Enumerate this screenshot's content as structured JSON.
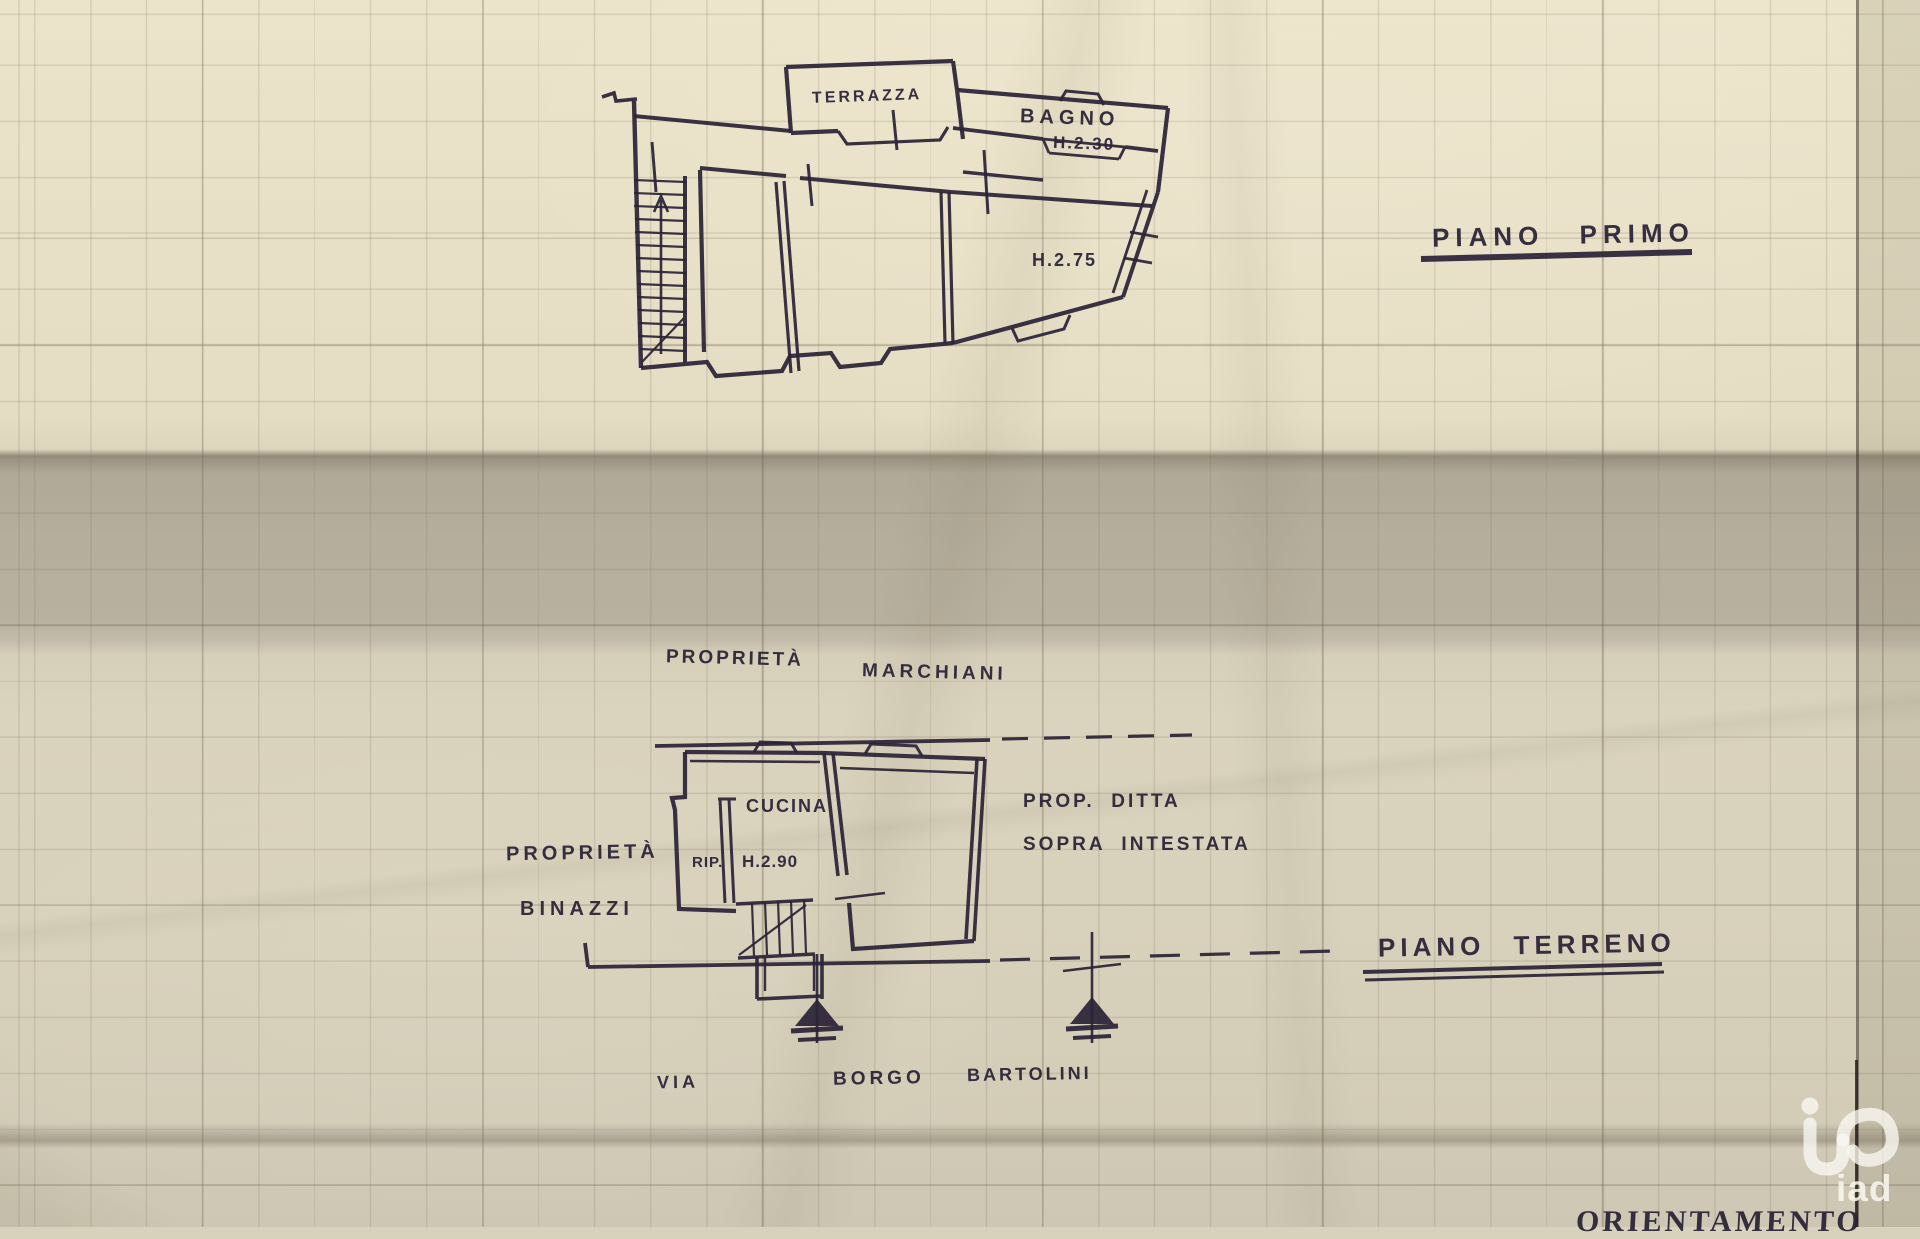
{
  "colors": {
    "ink": "#2b2437",
    "paper_top": "#e7dfc5",
    "paper_fold_band": "#b2aa98",
    "paper_lower": "#d7d0ba",
    "watermark": "#f8f6f0"
  },
  "first_floor": {
    "title": "PIANO PRIMO",
    "terrazza": "TERRAZZA",
    "bagno": "BAGNO",
    "bagno_height": "H.2.30",
    "room_height": "H.2.75"
  },
  "ground_floor": {
    "title": "PIANO TERRENO",
    "cucina": "CUCINA",
    "rip": "RIP.",
    "cucina_height": "H.2.90",
    "north_neighbor_word1": "PROPRIETÀ",
    "north_neighbor_word2": "MARCHIANI",
    "west_neighbor_word1": "PROPRIETÀ",
    "west_neighbor_word2": "BINAZZI",
    "east_neighbor_line1": "PROP.  DITTA",
    "east_neighbor_line2": "SOPRA  INTESTATA",
    "street_word1": "VIA",
    "street_word2": "BORGO",
    "street_word3": "BARTOLINI"
  },
  "footer": {
    "orientation_label": "ORIENTAMENTO"
  },
  "watermark": {
    "logo_text": "iad"
  }
}
